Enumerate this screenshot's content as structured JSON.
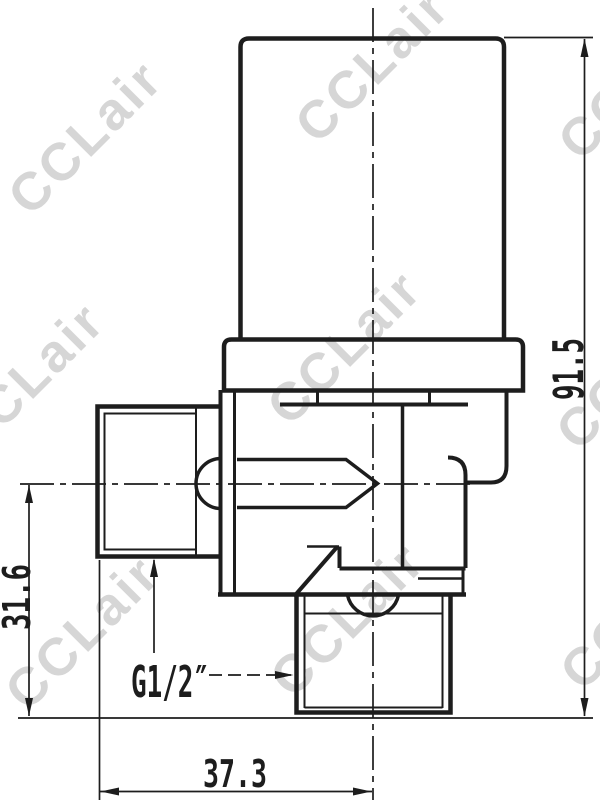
{
  "watermark": {
    "text": "CCLair",
    "color": "#d6d6d6"
  },
  "drawing": {
    "background_color": "#ffffff",
    "line_color": "#1d1d1d",
    "dimensions": {
      "overall_height": "91.5",
      "axis_to_outlet_bottom": "31.6",
      "inlet_face_to_outlet_axis": "37.3",
      "thread_label": "G1/2″"
    }
  }
}
